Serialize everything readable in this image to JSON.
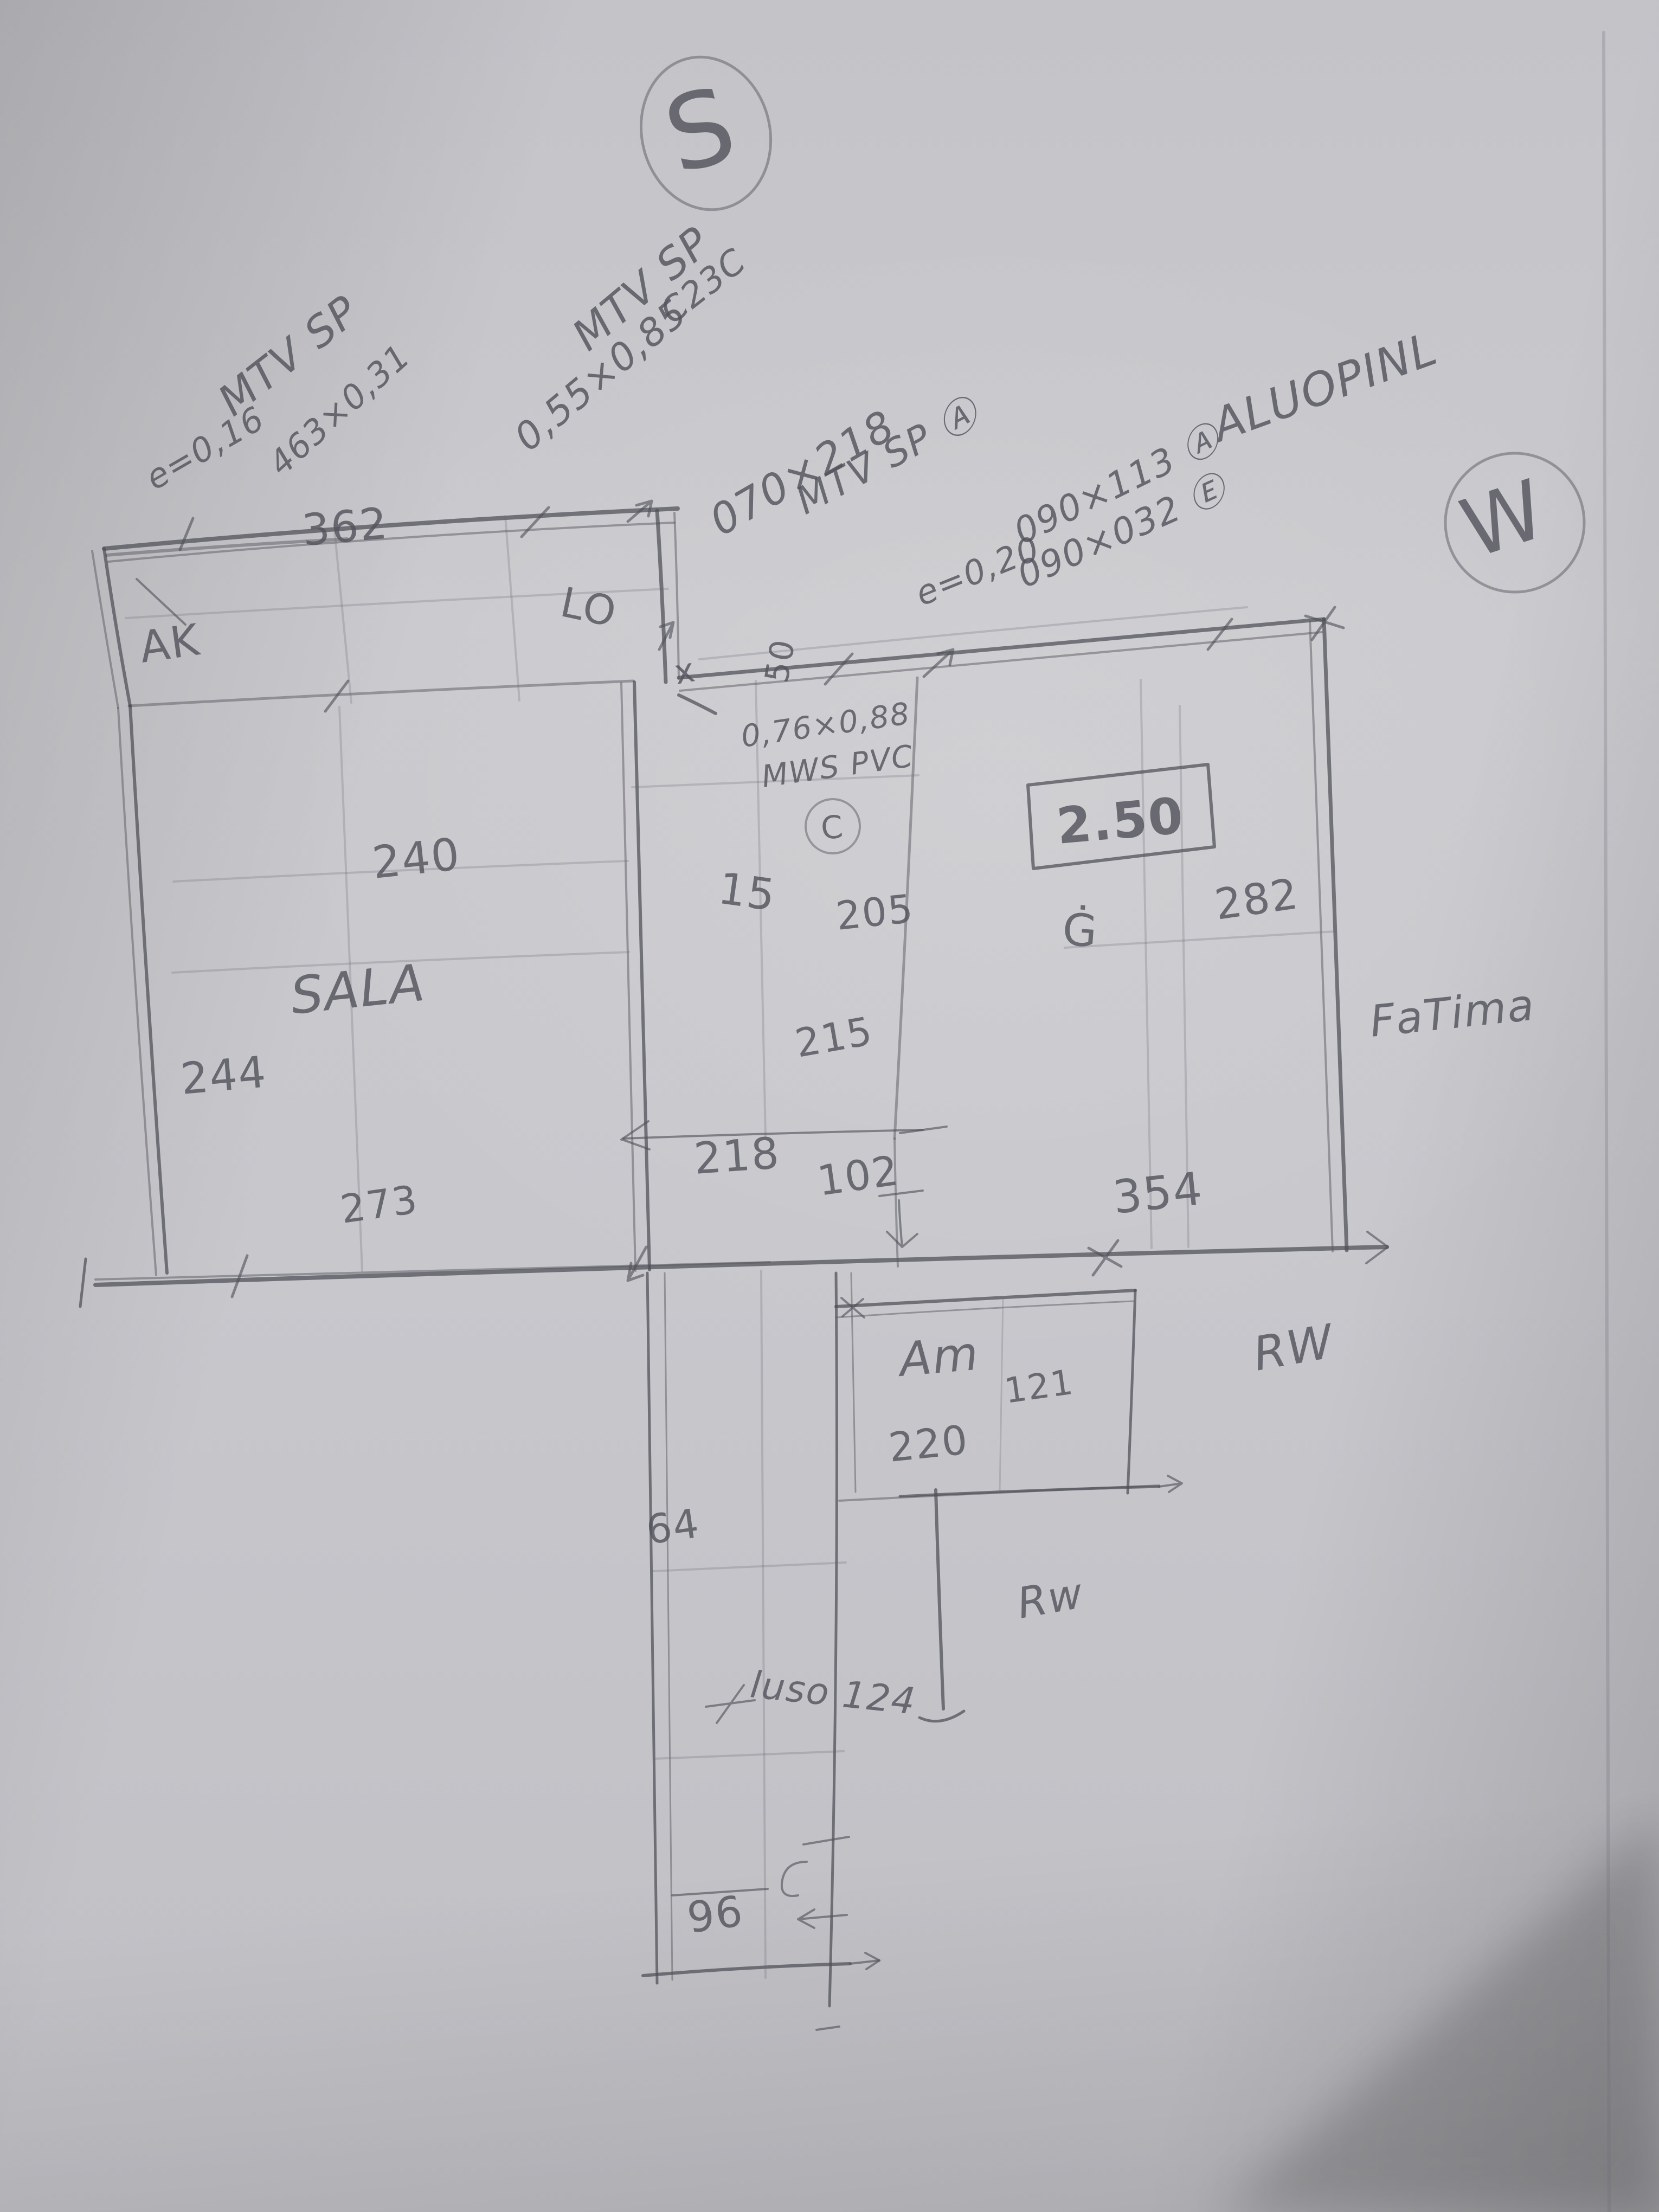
{
  "sheet": {
    "medium": "hand-drawn pencil floor plan sketch on paper",
    "paper_color": "#c7c7cb",
    "pencil_color": "#54545e"
  },
  "compass": {
    "south": "S",
    "west": "W"
  },
  "window_notes": {
    "nw": {
      "l1": "MTV SP",
      "l2": "e=0,16",
      "l3": "463×0,31"
    },
    "n": {
      "l1": "MTV SP",
      "l2": "0,55×0,85",
      "l3": "C23C"
    },
    "door": {
      "l1": "070×218",
      "l2": "MTV SP Ⓐ"
    },
    "ne": {
      "thickness": "e=0,20",
      "l1": "090×113 Ⓐ",
      "l2": "090×032 Ⓔ",
      "material": "ALUOPINL"
    },
    "mid": {
      "l1": "0,76×0,88",
      "l2": "MWS PVC",
      "badge": "C"
    }
  },
  "labels": {
    "ak": "AK",
    "lo": "LO",
    "sala": "SALA",
    "fatima": "FaTima",
    "am": "Am",
    "rw_upper": "RW",
    "rw_lower": "Rw",
    "luso": "luso 124",
    "g": "Ġ",
    "x": "x",
    "boxed": "2.50"
  },
  "dims": {
    "d362": "362",
    "d240": "240",
    "d244": "244",
    "d273": "273",
    "d15": "15",
    "d205": "205",
    "d215": "215",
    "d218": "218",
    "d102": "102",
    "d50": "50",
    "d282": "282",
    "d354": "354",
    "d121": "121",
    "d220": "220",
    "d64": "64",
    "d96": "96"
  }
}
